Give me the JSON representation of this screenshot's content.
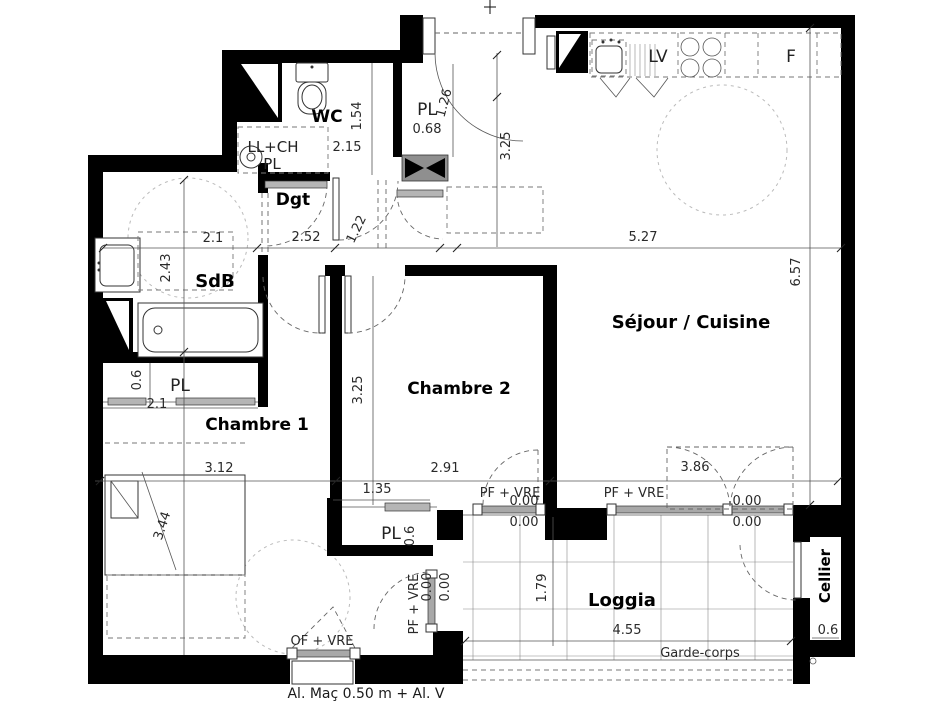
{
  "rooms": {
    "wc": "WC",
    "dgt": "Dgt",
    "sdb": "SdB",
    "chambre1": "Chambre 1",
    "chambre2": "Chambre 2",
    "sejour_cuisine": "Séjour / Cuisine",
    "loggia": "Loggia",
    "cellier": "Cellier"
  },
  "closets": {
    "pl": "PL",
    "ll_ch": "LL+CH",
    "entry_pl_size": "0.68"
  },
  "kitchen": {
    "dishwasher": "LV",
    "fridge": "F"
  },
  "dims": {
    "wc_width": "2.15",
    "wc_depth": "1.54",
    "entry_closet_depth": "1.26",
    "entry_depth": "3.25",
    "sdb_width": "2.1",
    "dgt_width": "2.52",
    "dgt_depth": "1.22",
    "sejour_width": "5.27",
    "sejour_depth": "6.57",
    "sdb_depth": "2.43",
    "pl1_depth": "0.6",
    "pl1_width": "2.1",
    "chambre1_width": "3.12",
    "chambre2_width": "2.91",
    "bay_width": "3.86",
    "chambre2_depth": "3.25",
    "bed_diagonal": "3.44",
    "pl2_width": "1.35",
    "pl2_depth": "0.6",
    "loggia_depth": "1.79",
    "loggia_width": "4.55",
    "cellier_width": "0.6",
    "threshold": "0.00"
  },
  "openings": {
    "pf_vre": "PF + VRE",
    "of_vre": "OF + VRE"
  },
  "notes": {
    "garde_corps": "Garde-corps",
    "al_mac": "Al. Maç 0.50 m + Al. V"
  }
}
